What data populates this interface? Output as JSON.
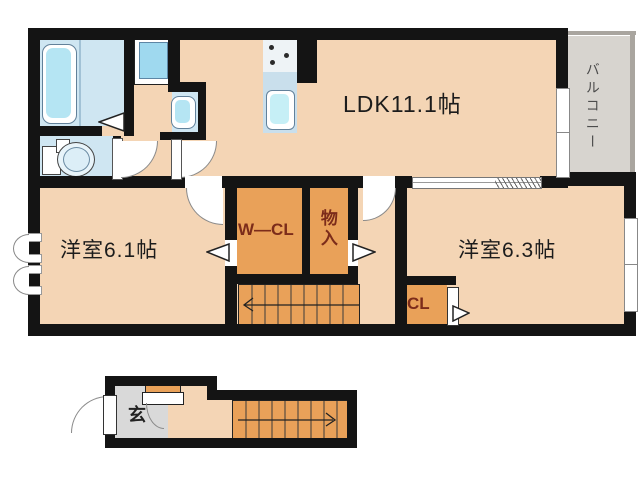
{
  "title": "apartment floor plan",
  "rooms": {
    "ldk": {
      "label": "LDK11.1帖"
    },
    "bedroom_west": {
      "label": "洋室6.1帖"
    },
    "bedroom_east": {
      "label": "洋室6.3帖"
    },
    "walkin_closet": {
      "label": "W—CL"
    },
    "storage": {
      "label": "物入"
    },
    "closet": {
      "label": "CL"
    },
    "balcony": {
      "label": "バルコニー"
    },
    "entrance": {
      "label": "玄"
    }
  },
  "colors": {
    "wall": "#141414",
    "floor_main": "#f4d5b5",
    "closet_orange": "#e9a159",
    "wet_room_blue": "#cfe6f2",
    "fixture_inner_blue": "#b5e5f3",
    "kitchen_counter": "#c9dfec",
    "balcony_gray": "#d7d4cf",
    "entrance_gray": "#d9d9d9",
    "closet_text": "#7c2c1a"
  }
}
